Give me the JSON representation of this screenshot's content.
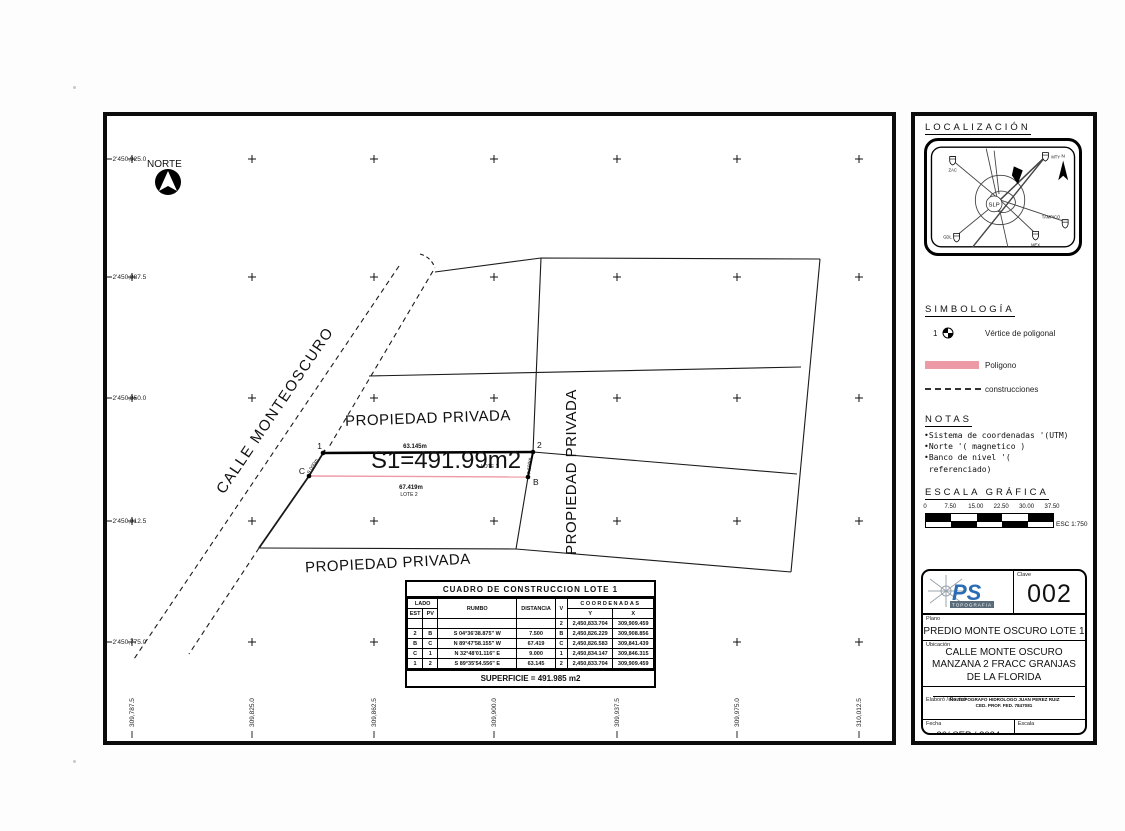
{
  "page": {
    "norte_label": "NORTE",
    "street_label": "CALLE MONTEOSCURO",
    "private_top": "PROPIEDAD PRIVADA",
    "private_bottom": "PROPIEDAD PRIVADA",
    "private_right": "PROPIEDAD PRIVADA",
    "lot": {
      "area_label": "S1=491.99m2",
      "lote1": "LOTE 1",
      "lote2": "LOTE 2",
      "dim_top": "63.145m",
      "dim_bottom": "67.419m",
      "dim_left": "9.000m",
      "dim_right": "7.500m",
      "v1": "1",
      "v2": "2",
      "vb": "B",
      "vc": "C"
    },
    "grid": {
      "y_labels": [
        "2'450,925.0",
        "2'450,887.5",
        "2'450,850.0",
        "2'450,812.5",
        "2'450,775.0"
      ],
      "x_labels": [
        "309,787.5",
        "309,825.0",
        "309,862.5",
        "309,900.0",
        "309,937.5",
        "309,975.0",
        "310,012.5"
      ]
    }
  },
  "table": {
    "title": "CUADRO DE CONSTRUCCION LOTE 1",
    "col_lado": "LADO",
    "col_est": "EST",
    "col_pv": "PV",
    "col_rumbo": "RUMBO",
    "col_dist": "DISTANCIA",
    "col_v": "V",
    "col_coord": "COORDENADAS",
    "col_y": "Y",
    "col_x": "X",
    "rows": [
      [
        "",
        "",
        "",
        "",
        "2",
        "2,450,833.704",
        "309,909.459"
      ],
      [
        "2",
        "B",
        "S 04°36'38.875\" W",
        "7.500",
        "B",
        "2,450,826.229",
        "309,908.856"
      ],
      [
        "B",
        "C",
        "N 89°47'58.155\" W",
        "67.419",
        "C",
        "2,450,826.583",
        "309,841.439"
      ],
      [
        "C",
        "1",
        "N 32°48'01.116\" E",
        "9.000",
        "1",
        "2,450,834.147",
        "309,846.315"
      ],
      [
        "1",
        "2",
        "S 89°35'54.556\" E",
        "63.145",
        "2",
        "2,450,833.704",
        "309,909.459"
      ]
    ],
    "superficie": "SUPERFICIE = 491.985 m2"
  },
  "sidebar": {
    "localizacion": {
      "title": "LOCALIZACIÓN",
      "center": "SLP",
      "north": "N",
      "shields": [
        "ZAC",
        "MTY",
        "TAMPICO",
        "MEX",
        "GDL"
      ]
    },
    "simbologia": {
      "title": "SIMBOLOGÍA",
      "vertex_num": "1",
      "vertex_label": "Vértice de poligonal",
      "polygon_label": "Poligono",
      "construction_label": "construcciones"
    },
    "notas": {
      "title": "NOTAS",
      "lines": [
        "•Sistema de coordenadas '(UTM)",
        "•Norte '( magnetico )",
        "•Banco de nivel '(",
        " referenciado)"
      ]
    },
    "escala": {
      "title": "ESCALA GRÁFICA",
      "ticks": [
        "0",
        "7.50",
        "15.00",
        "22.50",
        "30.00",
        "37.50"
      ],
      "esc": "ESC 1:750"
    }
  },
  "titleblock": {
    "logo_text": "PS",
    "logo_sub": "TOPOGRAFIA",
    "clave_label": "Clave",
    "clave": "002",
    "plano_label": "Plano",
    "plano": "PREDIO MONTE OSCURO LOTE 1",
    "ubicacion_label": "Ubicación",
    "ubicacion_lines": [
      "CALLE MONTE OSCURO",
      "MANZANA 2 FRACC GRANJAS",
      "DE LA FLORIDA"
    ],
    "elaboro_label": "Elaboró / Revisó",
    "elaboro1": "ING.TOPOGRAFO HIDROLOGO JUAN PEREZ RUIZ",
    "elaboro2": "CED. PROF. FED. 7847081",
    "fecha_label": "Fecha",
    "fecha": "30/ SEP / 2024",
    "escala_label": "Escala",
    "escala": "1:750-Tabloide(17x11)"
  },
  "colors": {
    "polygon_pink": "#ee9aa6",
    "logo_blue": "#2a6db5"
  }
}
